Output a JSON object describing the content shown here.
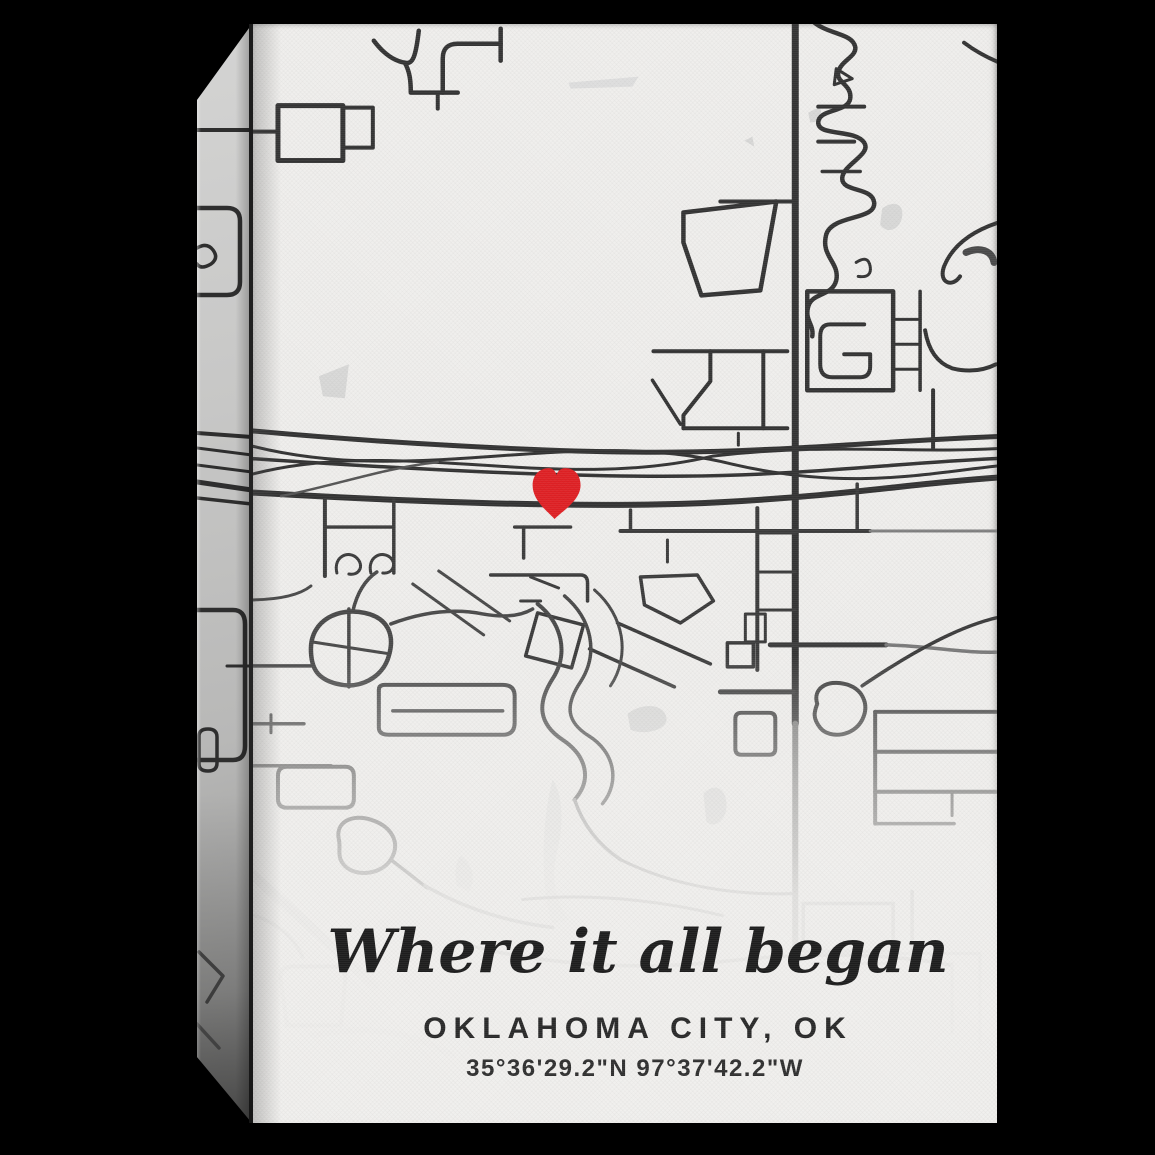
{
  "scene": {
    "type": "product-photo of stretched canvas wall art",
    "background_color": "#000000"
  },
  "canvas_print": {
    "map": {
      "style": "minimal black and white street map",
      "canvas_color": "#efeeec",
      "road_color": "#383838",
      "marker_icon": "red-heart",
      "marker_color": "#df2125"
    },
    "title": "Where it all began",
    "city": "OKLAHOMA CITY, OK",
    "coordinates": "35°36'29.2\"N 97°37'42.2\"W",
    "text_color": "#1e1e1e"
  }
}
